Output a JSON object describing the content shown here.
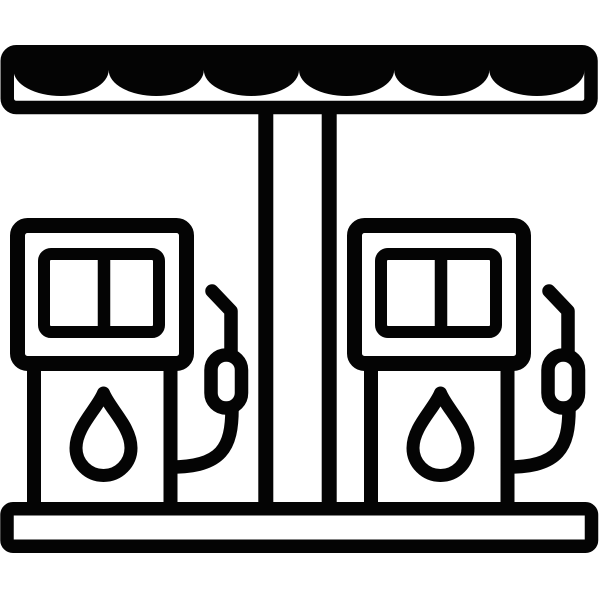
{
  "meta": {
    "title": "Gas station icon",
    "description": "Black outline pictogram of a fuel station: scalloped canopy roof, central support pillar, base platform, and two fuel pumps each with a two-pane display, a fuel drop symbol, and a nozzle with hose"
  },
  "colors": {
    "ink": "#040404",
    "background": "#ffffff"
  },
  "icon": {
    "name": "gas-station-icon",
    "pump_count": 2,
    "canopy_scallops": 6,
    "display_panes_per_pump": 2,
    "drop_symbols_per_pump": 1
  }
}
